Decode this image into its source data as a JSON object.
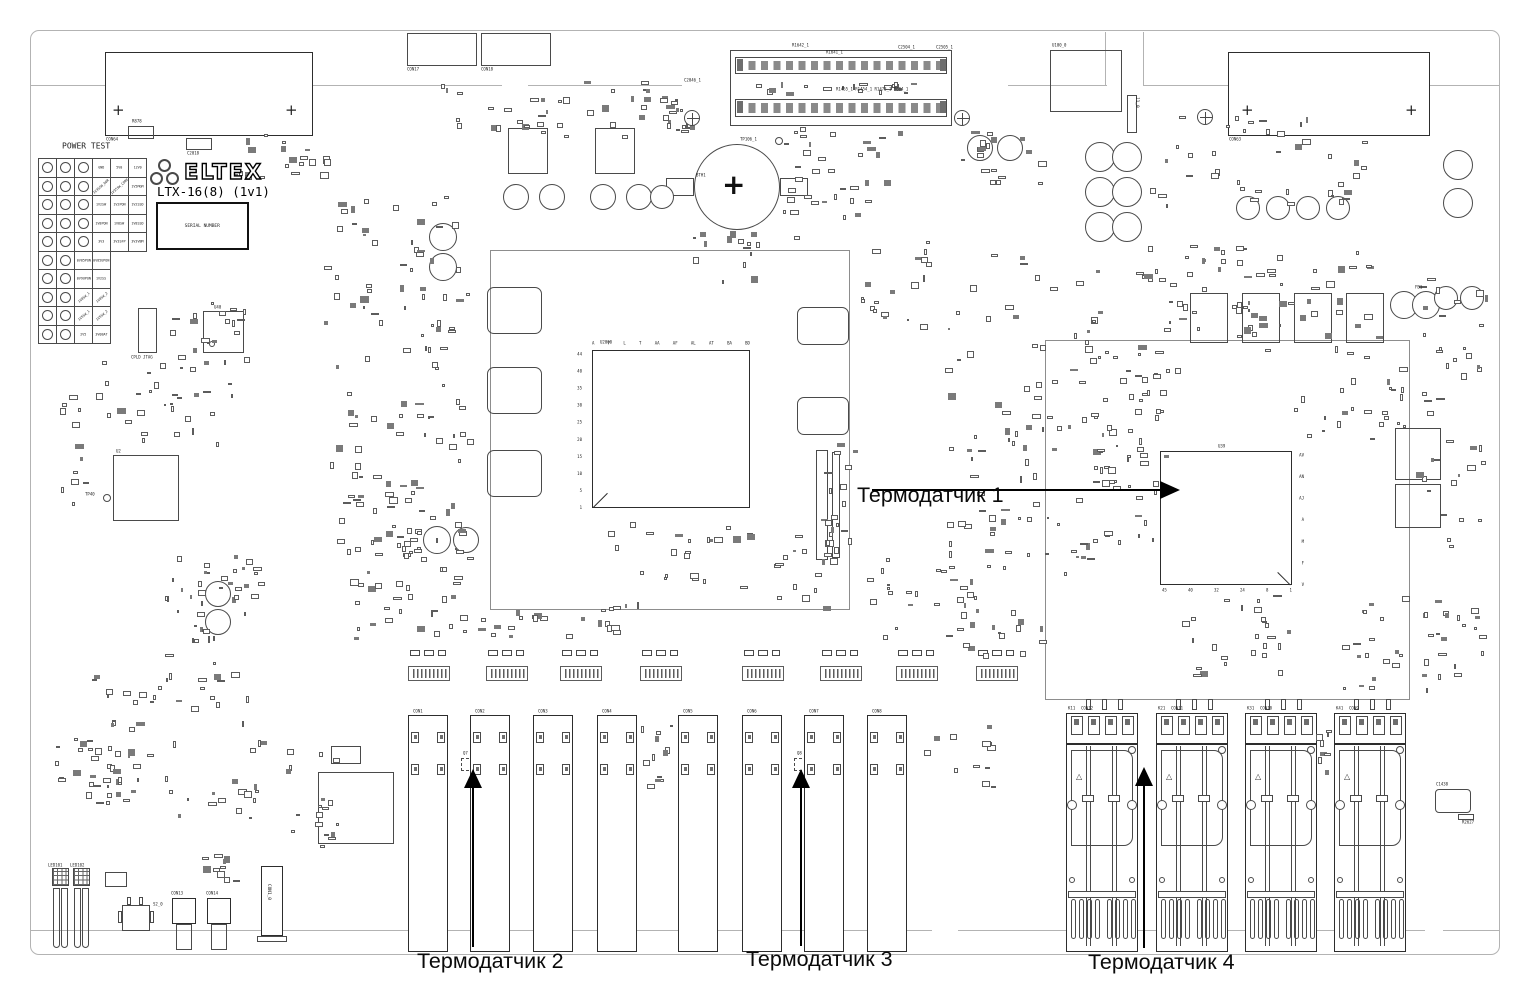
{
  "annotations": {
    "sensor1": {
      "label": "Термодатчик 1"
    },
    "sensor2": {
      "label": "Термодатчик 2"
    },
    "sensor3": {
      "label": "Термодатчик 3"
    },
    "sensor4": {
      "label": "Термодатчик 4"
    }
  },
  "board": {
    "brand": "ELTEX",
    "model": "LTX-16(8) (1v1)",
    "serial_box_text": "SERIAL NUMBER",
    "plus_mark": "+",
    "power_test": {
      "title": "POWER TEST",
      "rows": [
        {
          "circles": 3,
          "labels": [
            "GND",
            "5V0",
            "12V0"
          ],
          "diag": []
        },
        {
          "circles": 3,
          "labels": [
            "1V35SW_DDR",
            "1V35SW_CORE",
            "1V5MGM"
          ],
          "diag": [
            0,
            1
          ]
        },
        {
          "circles": 3,
          "labels": [
            "1V2SW",
            "1V2PON",
            "1V2SSD"
          ],
          "diag": []
        },
        {
          "circles": 3,
          "labels": [
            "1V8PON",
            "1V8SW",
            "1V8SSD"
          ],
          "diag": []
        },
        {
          "circles": 3,
          "labels": [
            "3V3",
            "3V3SFP",
            "3V3VBM"
          ],
          "diag": []
        },
        {
          "circles": 2,
          "labels": [
            "0V85PON",
            "0V85UPON"
          ],
          "diag": []
        },
        {
          "circles": 2,
          "labels": [
            "0V9UPON",
            "1V2SS"
          ],
          "diag": []
        },
        {
          "circles": 2,
          "labels": [
            "1V0SW_1",
            "1V0SW_2"
          ],
          "diag": [
            0,
            1
          ]
        },
        {
          "circles": 2,
          "labels": [
            "1V5SW_1",
            "1V5SW_2"
          ],
          "diag": [
            0,
            1
          ]
        },
        {
          "circles": 2,
          "labels": [
            "2V5",
            "3V0BAT"
          ],
          "diag": []
        }
      ]
    },
    "main_cpu": {
      "ref": "U2000",
      "columns": [
        "A",
        "F",
        "L",
        "T",
        "AA",
        "AF",
        "AL",
        "AT",
        "BA",
        "BD"
      ],
      "rows": [
        "44",
        "40",
        "35",
        "30",
        "25",
        "20",
        "15",
        "10",
        "5",
        "1"
      ]
    },
    "switch_chip": {
      "ref": "U39",
      "rows": [
        "AV",
        "AN",
        "AJ",
        "A",
        "M",
        "F",
        "V"
      ],
      "columns": [
        "45",
        "40",
        "32",
        "24",
        "8",
        "1"
      ]
    },
    "battery_ref": "BTH1",
    "front_connectors": [
      {
        "ref": "CON1",
        "x": 408
      },
      {
        "ref": "CON2",
        "x": 470
      },
      {
        "ref": "CON3",
        "x": 533
      },
      {
        "ref": "CON4",
        "x": 597
      },
      {
        "ref": "CON5",
        "x": 678
      },
      {
        "ref": "CON6",
        "x": 742
      },
      {
        "ref": "CON7",
        "x": 804
      },
      {
        "ref": "CON8",
        "x": 867
      }
    ],
    "sfp_cages": [
      {
        "k": "K11",
        "ref": "CON12",
        "x": 1066
      },
      {
        "k": "K21",
        "ref": "CON11",
        "x": 1156
      },
      {
        "k": "K31",
        "ref": "CON10",
        "x": 1245
      },
      {
        "k": "K41",
        "ref": "CON9",
        "x": 1334
      }
    ],
    "misc_labels": [
      {
        "text": "R878",
        "x": 132,
        "y": 119
      },
      {
        "text": "C2018",
        "x": 187,
        "y": 151
      },
      {
        "text": "CON64",
        "x": 106,
        "y": 137
      },
      {
        "text": "CON17",
        "x": 407,
        "y": 67
      },
      {
        "text": "CON18",
        "x": 481,
        "y": 67
      },
      {
        "text": "U100_0",
        "x": 1052,
        "y": 43
      },
      {
        "text": "J1_0",
        "x": 1140,
        "y": 97,
        "rot": 1
      },
      {
        "text": "CON63",
        "x": 1229,
        "y": 137
      },
      {
        "text": "TP106_1",
        "x": 740,
        "y": 137
      },
      {
        "text": "BTH1",
        "x": 696,
        "y": 173
      },
      {
        "text": "R1642_1",
        "x": 792,
        "y": 43
      },
      {
        "text": "R1641_1",
        "x": 826,
        "y": 50
      },
      {
        "text": "C2504_1",
        "x": 898,
        "y": 45
      },
      {
        "text": "C2505_1",
        "x": 936,
        "y": 45
      },
      {
        "text": "C2046_1",
        "x": 684,
        "y": 78
      },
      {
        "text": "R1455_1 R1454_1 R1473_1 R604_1",
        "x": 836,
        "y": 87
      },
      {
        "text": "U2000",
        "x": 600,
        "y": 340
      },
      {
        "text": "U40",
        "x": 214,
        "y": 305
      },
      {
        "text": "CPLD JTAG",
        "x": 131,
        "y": 355
      },
      {
        "text": "TP40",
        "x": 85,
        "y": 492
      },
      {
        "text": "U2",
        "x": 116,
        "y": 449
      },
      {
        "text": "U39",
        "x": 1218,
        "y": 444
      },
      {
        "text": "Q7",
        "x": 463,
        "y": 751
      },
      {
        "text": "Q8",
        "x": 797,
        "y": 751
      },
      {
        "text": "C1438",
        "x": 1436,
        "y": 782
      },
      {
        "text": "R2627",
        "x": 1462,
        "y": 820
      },
      {
        "text": "CON13",
        "x": 171,
        "y": 891
      },
      {
        "text": "CON14",
        "x": 206,
        "y": 891
      },
      {
        "text": "LED101",
        "x": 48,
        "y": 863
      },
      {
        "text": "LED102",
        "x": 70,
        "y": 863
      },
      {
        "text": "S2_0",
        "x": 153,
        "y": 902
      },
      {
        "text": "CON1_0",
        "x": 272,
        "y": 884,
        "rot": 1
      },
      {
        "text": "FB1",
        "x": 1415,
        "y": 285
      }
    ]
  }
}
